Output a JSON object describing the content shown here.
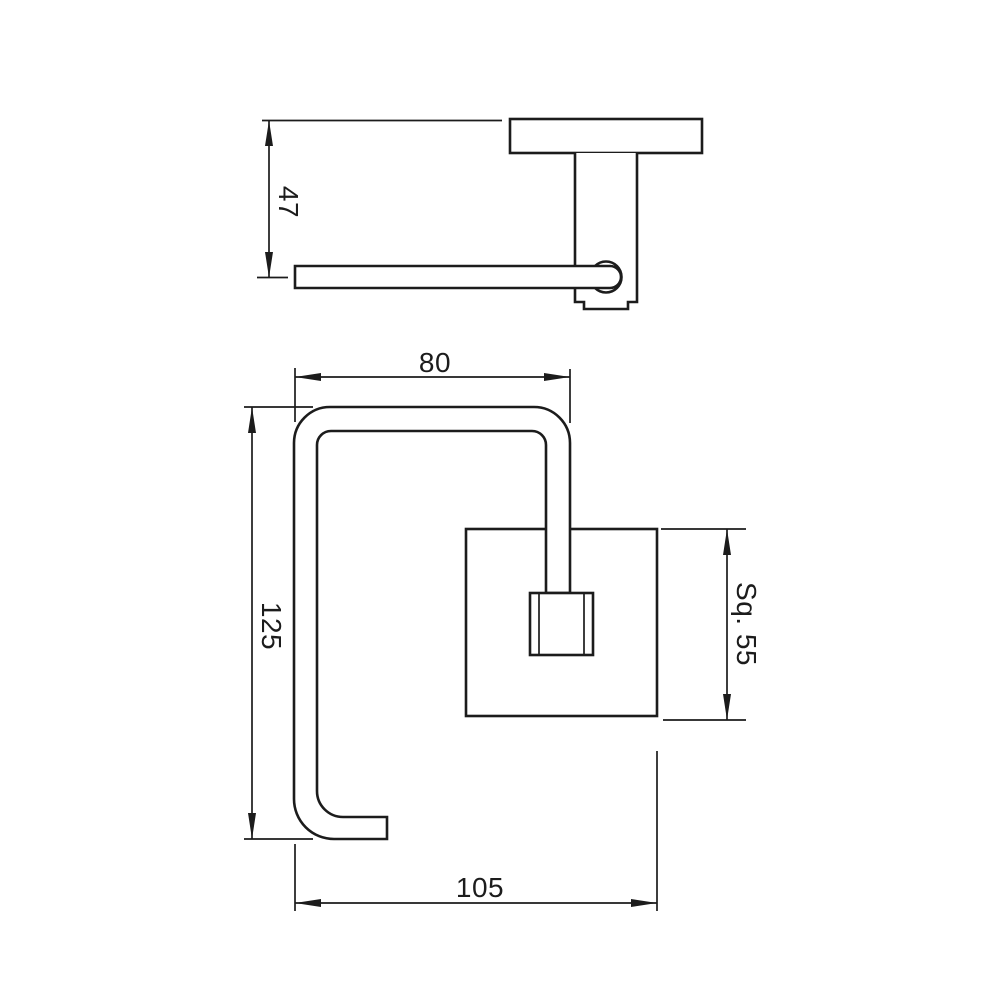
{
  "colors": {
    "background": "#ffffff",
    "line": "#1c1c1c",
    "text": "#1c1c1c"
  },
  "views": {
    "side_view": {
      "description_parts": [
        "wall-plate",
        "mounting-post",
        "pivot-circle",
        "roll-bar"
      ],
      "dimensions": {
        "height": "47"
      }
    },
    "front_view": {
      "description_parts": [
        "bent-bar-tube",
        "square-back-plate",
        "mounting-block"
      ],
      "dimensions": {
        "top_width": "80",
        "overall_height": "125",
        "overall_width": "105",
        "back_plate_square": "Sq. 55"
      }
    }
  }
}
